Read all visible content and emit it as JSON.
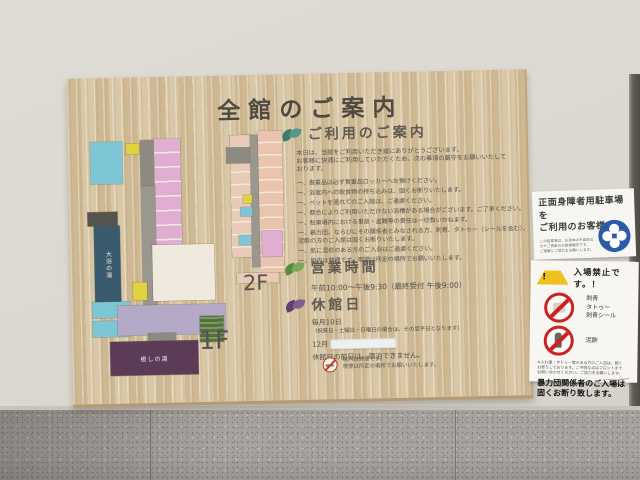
{
  "board": {
    "title": "全館のご案内",
    "floors": {
      "label_2f": "2F",
      "label_1f": "1F",
      "bath_blue": "大浴の湯",
      "bath_purple": "癒しの湯"
    },
    "guide": {
      "heading": "ご利用のご案内",
      "intro": [
        "本日は、当館をご利用いただき誠にありがとうございます。",
        "お客様に快適にご利用していただくため、次の事項の厳守をお願いいたして",
        "おります。"
      ],
      "rules": [
        "一、貴重品は必ず貴重品ロッカーへお預けください。",
        "一、浴室内への飲食物の持ち込みは、固くお断りいたします。",
        "一、ペットを連れてのご入館は、ご遠慮ください。",
        "一、都合によりご利用いただけない浴槽がある場合がございます。ご了承ください。",
        "一、駐車場内における事故・盗難等の責任は一切負いかねます。",
        "一、暴力団、ならびにその関係者とみなされる方、刺青、タトゥー（シールを含む）、泥酔の方のご入館は固くお断りいたします。",
        "一、肌に湿疹のある方のご入浴はご遠慮ください。",
        "一、館内は禁煙です。喫煙は所定の場所でお願いいたします。"
      ]
    },
    "hours": {
      "heading": "営業時間",
      "text": "午前10:00〜午後9:30（最終受付 午後9:00）"
    },
    "closed": {
      "heading": "休館日",
      "line1": "毎月10日",
      "line2": "（祝祭日・土曜日・日曜日の場合は、その翌平日となります）",
      "line3_prefix": "12月",
      "line4": "休館日の前日は、宿泊できません。"
    },
    "smoking": {
      "line1": "館内は禁煙です。",
      "line2": "喫煙は所定の場所でお願いいたします。"
    }
  },
  "notices": {
    "parking": {
      "title1": "正面身障者用駐車場を",
      "title2": "ご利用のお客様へ",
      "small1": "この駐車場は、お身体の不自由な",
      "small2": "方やご高齢のお客様優先です。",
      "small3": "ご理解とご協力をお願いします。"
    },
    "no_entry": {
      "title": "入場禁止です。！",
      "tattoo1": "刺青",
      "tattoo2": "タトゥー",
      "tattoo3": "刺青シール",
      "drunk": "泥酔",
      "fine1": "※入れ墨・タトゥー等のある方のご入浴は、固く",
      "fine2": "お断りしております。ご不明な点はフロントまで",
      "fine3": "お問い合わせください。ご協力をお願いします。",
      "bold1": "暴力団関係者のご入場は",
      "bold2": "固くお断り致します。"
    }
  },
  "colors": {
    "wood": "#d4c09c",
    "wall": "#dbd9d1",
    "granite": "#a7a39e",
    "room_pink": "#dfaed2",
    "room_cyan": "#7cc6d6",
    "room_yellow": "#e0d23e",
    "room_teal": "#7fc9a8",
    "bath_blue": "#3a5a6e",
    "bath_purple": "#5c3b57",
    "lobby_purple": "#b4a9c6",
    "corridor_gray": "#9a978f",
    "notice_blue": "#2a5aa8",
    "prohibit_red": "#cc2222"
  }
}
